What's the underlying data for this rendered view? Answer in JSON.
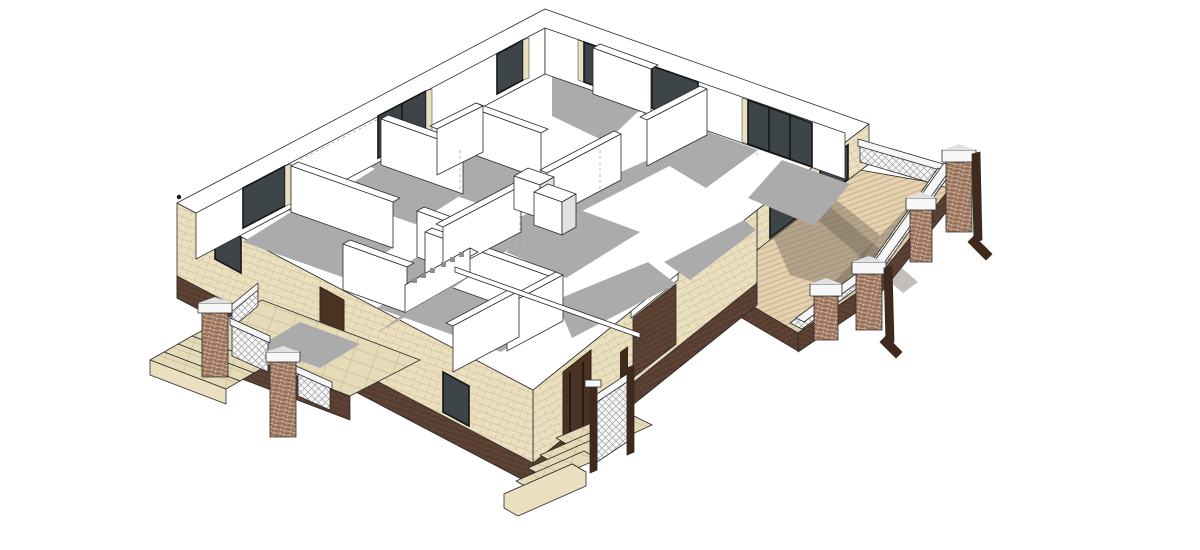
{
  "app": {
    "title": "3D architectural model — single-story house cutaway, axonometric view",
    "render_style": "sketchup-like line render, flat shading, white background"
  },
  "scene": {
    "view": "isometric top-down cutaway (no roof)",
    "building": "single-story brick house with interior partition walls exposed",
    "parts": {
      "exterior_walls": "cream brick with dark brown brick base band",
      "interior_walls": "white with thin outlines and gray cast shadows",
      "windows": "dark glazed openings with black frames, 9 visible",
      "doors": "dark brown wood, 2 visible",
      "deck": "wood plank terrace on right with brick pillars, white lattice railings, dark corner posts",
      "porch_left": "tiled porch with steps, brick pillars and white lattice railing",
      "porch_bottom": "small stair porch with white railing and dark wood posts",
      "pillar_caps": "white stone caps",
      "decor_screen": "low interior screen wall with square perforations"
    }
  },
  "colors": {
    "background": "#ffffff",
    "outline": "#2b2b2b",
    "wall_white": "#ffffff",
    "shadow": "#ababab",
    "shadow_wood": "rgba(112,101,88,0.42)",
    "brick_cream": "#eadfbf",
    "brick_cream_line": "#d2c39c",
    "brick_base": "#5e4334",
    "brick_base_line": "#49332a",
    "brick_pillar": "#9a7057",
    "brick_pillar_line": "#e9e1d6",
    "window_glass": "#3e4549",
    "window_frame": "#161616",
    "door_wood": "#4a3322",
    "door_wood_dark": "#32230f",
    "deck_wood": "#e3d1af",
    "deck_wood_line": "#bfa47d",
    "porch_tile": "#e5dbb8",
    "porch_tile_line": "#cbbd97",
    "railing_white": "#f7f7f7",
    "railing_detail": "#9f9f9f",
    "post_dark": "#3f2a1b",
    "cap_shade": "#e1e1e1"
  }
}
